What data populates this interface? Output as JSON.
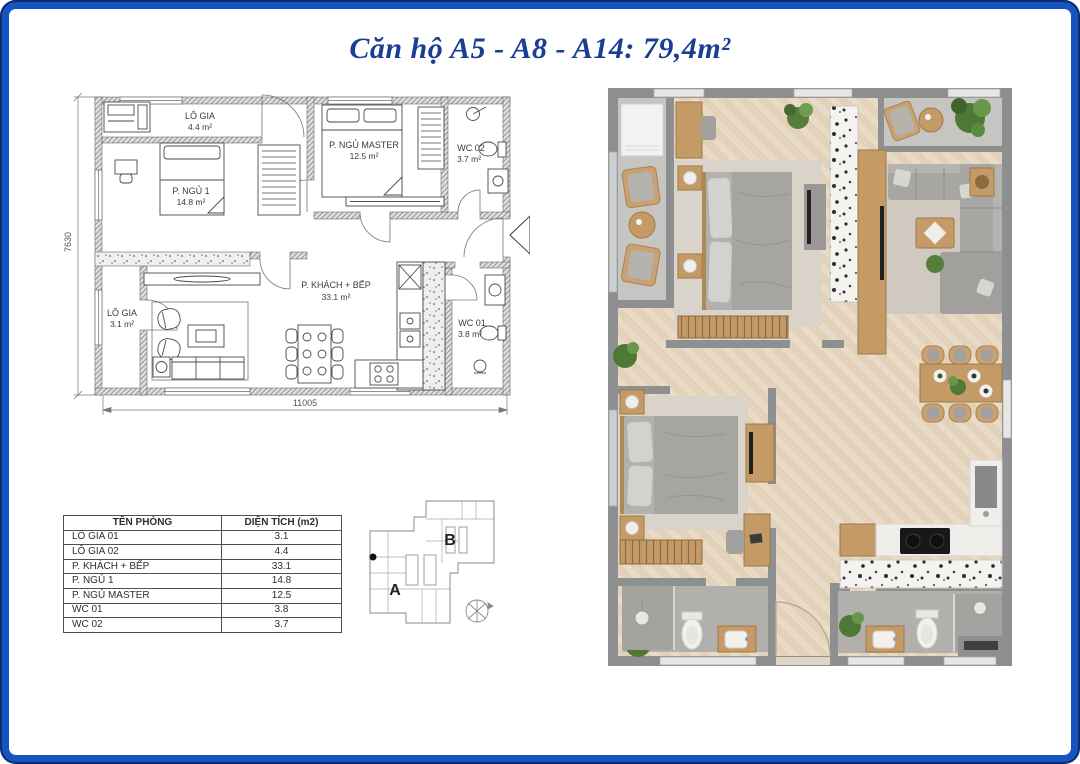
{
  "frame": {
    "border_color": "#1753c1"
  },
  "title": "Căn hộ A5 - A8 - A14: 79,4m²",
  "plan2d": {
    "rooms": [
      {
        "name": "LÔ GIA",
        "area": "4.4 m²"
      },
      {
        "name": "P. NGỦ 1",
        "area": "14.8 m²"
      },
      {
        "name": "P. NGỦ MASTER",
        "area": "12.5 m²"
      },
      {
        "name": "WC 02",
        "area": "3.7 m²"
      },
      {
        "name": "P. KHÁCH + BẾP",
        "area": "33.1 m²"
      },
      {
        "name": "LÔ GIA",
        "area": "3.1 m²"
      },
      {
        "name": "WC 01",
        "area": "3.8 m²"
      }
    ],
    "dimensions": {
      "vertical": "7630",
      "horizontal": "11005"
    }
  },
  "area_table": {
    "headers": [
      "TÊN PHÒNG",
      "DIỆN TÍCH (m2)"
    ],
    "rows": [
      [
        "LÔ GIA 01",
        "3.1"
      ],
      [
        "LÔ GIA 02",
        "4.4"
      ],
      [
        "P. KHÁCH + BẾP",
        "33.1"
      ],
      [
        "P. NGỦ 1",
        "14.8"
      ],
      [
        "P. NGỦ MASTER",
        "12.5"
      ],
      [
        "WC 01",
        "3.8"
      ],
      [
        "WC 02",
        "3.7"
      ]
    ]
  },
  "key_plan": {
    "section_a": "A",
    "section_b": "B"
  }
}
